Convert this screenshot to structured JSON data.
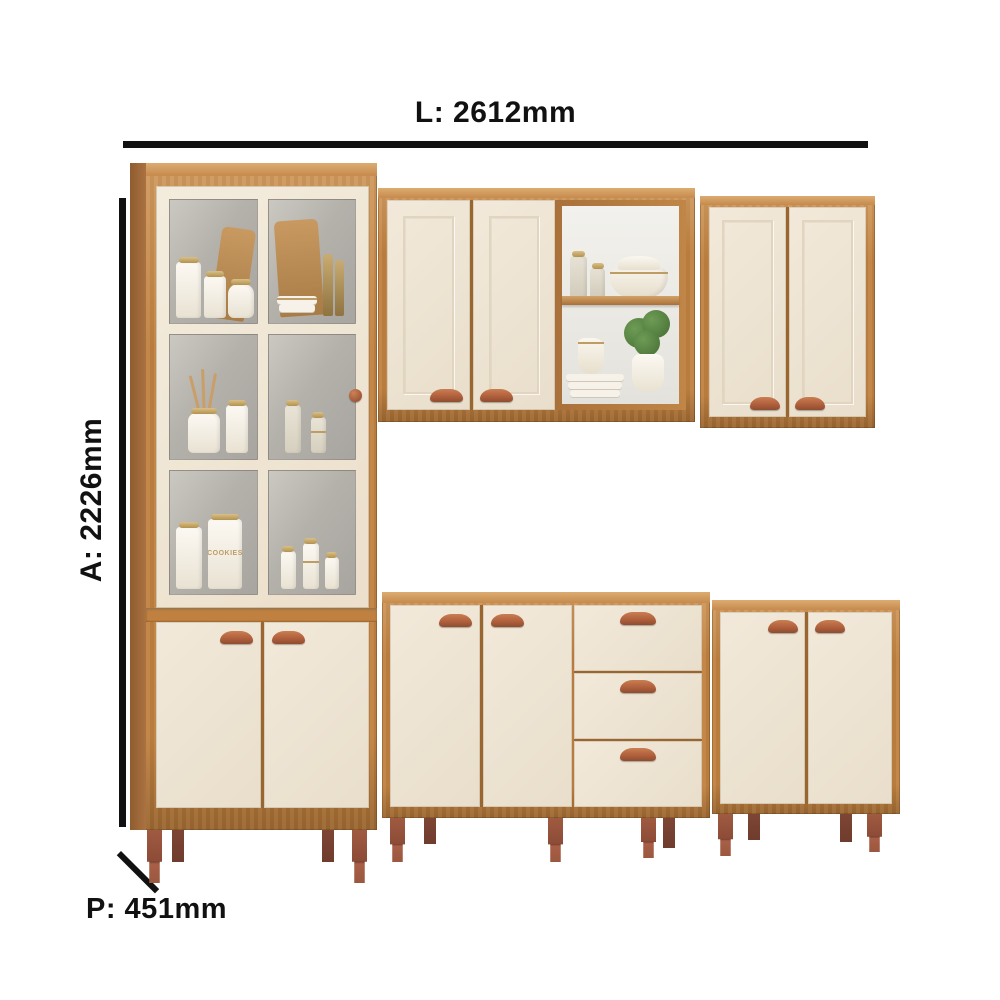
{
  "annotations": {
    "width_label": "L: 2612mm",
    "height_label": "A: 2226mm",
    "depth_label": "P: 451mm"
  },
  "decor": {
    "cookies_jar_label": "COOKIES"
  },
  "colors": {
    "line": "#111111",
    "wood": "#c08140",
    "wood-light": "#d09a5e",
    "wood-deep": "#9a6630",
    "cream": "#f2e9da",
    "cream-shade": "#e9decb",
    "handle": "#b1603c",
    "handle-light": "#c97e52",
    "handle-dark": "#8e4d31",
    "gold": "#bd9d63",
    "glass": "#b4b1ab",
    "leg": "#9b5740",
    "plant": "#55823f",
    "wall": "#f0efeb"
  }
}
